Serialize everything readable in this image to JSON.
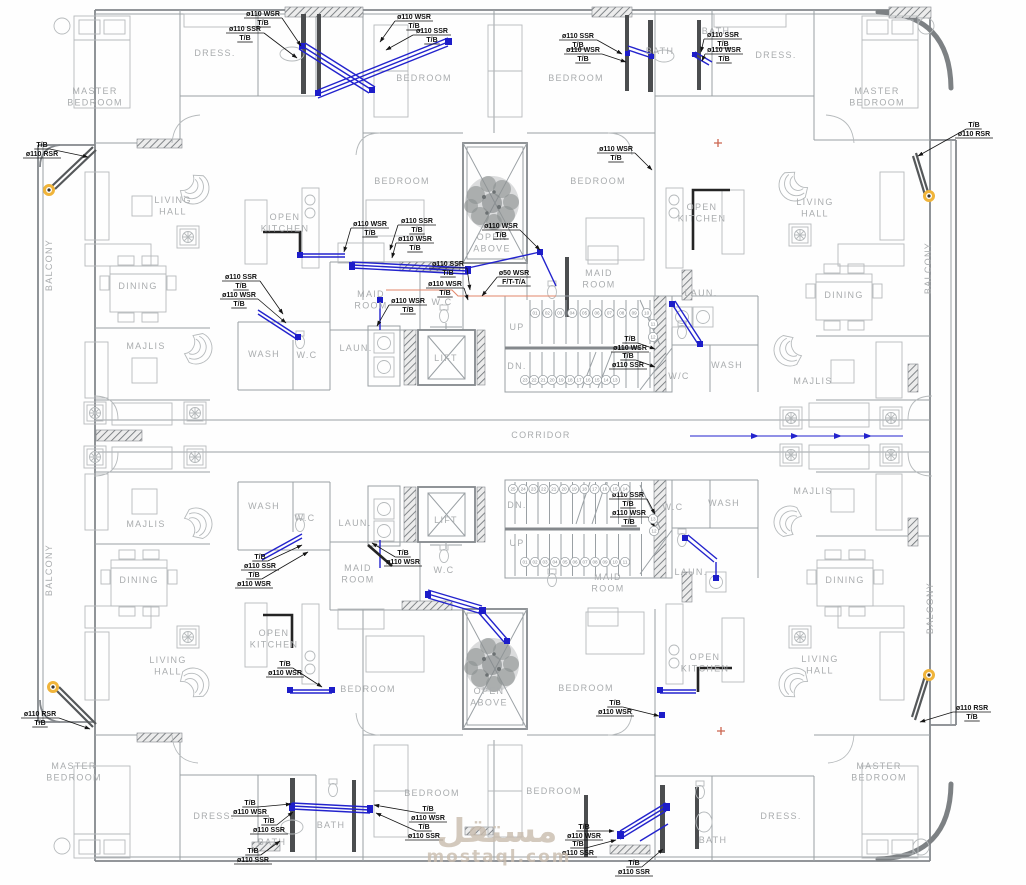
{
  "watermark": {
    "arabic": "مستقل",
    "latin": "mostaql.com"
  },
  "colors": {
    "pipe_blue": "#2323cd",
    "wall_gray": "#9aa0a4",
    "annotation_black": "#0f0f0f",
    "room_text_gray": "#a9acae",
    "rsr_marker_yellow": "#f0b43a",
    "orange_line": "#e2876a",
    "marker_red": "#cc6650",
    "watermark_tan": "#c9bcae"
  },
  "room_labels": [
    {
      "name": "master-bedroom-tl",
      "lines": [
        "MASTER",
        "BEDROOM"
      ],
      "x": 95,
      "y": 94
    },
    {
      "name": "dress-tl",
      "lines": [
        "DRESS."
      ],
      "x": 215,
      "y": 56
    },
    {
      "name": "bedroom-top-1",
      "lines": [
        "BEDROOM"
      ],
      "x": 424,
      "y": 81
    },
    {
      "name": "bedroom-top-2",
      "lines": [
        "BEDROOM"
      ],
      "x": 576,
      "y": 81
    },
    {
      "name": "bath-top-center",
      "lines": [
        "BATH"
      ],
      "x": 660,
      "y": 54
    },
    {
      "name": "bath-top-right",
      "lines": [
        "BATH"
      ],
      "x": 716,
      "y": 34
    },
    {
      "name": "dress-tr",
      "lines": [
        "DRESS."
      ],
      "x": 776,
      "y": 58
    },
    {
      "name": "master-bedroom-tr",
      "lines": [
        "MASTER",
        "BEDROOM"
      ],
      "x": 877,
      "y": 94
    },
    {
      "name": "bedroom-mid-1",
      "lines": [
        "BEDROOM"
      ],
      "x": 402,
      "y": 184
    },
    {
      "name": "bedroom-mid-2",
      "lines": [
        "BEDROOM"
      ],
      "x": 598,
      "y": 184
    },
    {
      "name": "open-above-top",
      "lines": [
        "OPEN",
        "ABOVE"
      ],
      "x": 492,
      "y": 240
    },
    {
      "name": "living-hall-tl",
      "lines": [
        "LIVING",
        "HALL"
      ],
      "x": 173,
      "y": 203
    },
    {
      "name": "open-kitchen-tl",
      "lines": [
        "OPEN",
        "KITCHEN"
      ],
      "x": 285,
      "y": 220
    },
    {
      "name": "open-kitchen-tr",
      "lines": [
        "OPEN",
        "KITCHEN"
      ],
      "x": 702,
      "y": 210
    },
    {
      "name": "living-hall-tr",
      "lines": [
        "LIVING",
        "HALL"
      ],
      "x": 815,
      "y": 205
    },
    {
      "name": "maid-room-top-left",
      "lines": [
        "MAID",
        "ROOM"
      ],
      "x": 371,
      "y": 297
    },
    {
      "name": "maid-room-top-right",
      "lines": [
        "MAID",
        "ROOM"
      ],
      "x": 599,
      "y": 276
    },
    {
      "name": "dining-tl",
      "lines": [
        "DINING"
      ],
      "x": 138,
      "y": 289
    },
    {
      "name": "dining-tr",
      "lines": [
        "DINING"
      ],
      "x": 844,
      "y": 298
    },
    {
      "name": "wash-upper-left",
      "lines": [
        "WASH"
      ],
      "x": 264,
      "y": 357
    },
    {
      "name": "wc-upper-left",
      "lines": [
        "W.C"
      ],
      "x": 307,
      "y": 358
    },
    {
      "name": "wc-upper-center",
      "lines": [
        "W.C"
      ],
      "x": 442,
      "y": 305
    },
    {
      "name": "laun-upper-left",
      "lines": [
        "LAUN."
      ],
      "x": 356,
      "y": 351
    },
    {
      "name": "lift-upper",
      "lines": [
        "LIFT"
      ],
      "x": 446,
      "y": 361
    },
    {
      "name": "majlis-tl",
      "lines": [
        "MAJLIS"
      ],
      "x": 146,
      "y": 349
    },
    {
      "name": "majlis-tr",
      "lines": [
        "MAJLIS"
      ],
      "x": 813,
      "y": 384
    },
    {
      "name": "up-upper",
      "lines": [
        "UP"
      ],
      "x": 517,
      "y": 330
    },
    {
      "name": "dn-upper",
      "lines": [
        "DN."
      ],
      "x": 517,
      "y": 369
    },
    {
      "name": "laun-upper-right",
      "lines": [
        "LAUN."
      ],
      "x": 701,
      "y": 296
    },
    {
      "name": "wash-upper-right",
      "lines": [
        "WASH"
      ],
      "x": 727,
      "y": 368
    },
    {
      "name": "wc-upper-right",
      "lines": [
        "W/C"
      ],
      "x": 679,
      "y": 379
    },
    {
      "name": "corridor",
      "lines": [
        "CORRIDOR"
      ],
      "x": 541,
      "y": 438
    },
    {
      "name": "wash-lower-left",
      "lines": [
        "WASH"
      ],
      "x": 264,
      "y": 509
    },
    {
      "name": "wc-lower-left",
      "lines": [
        "W.C"
      ],
      "x": 305,
      "y": 521
    },
    {
      "name": "majlis-bl",
      "lines": [
        "MAJLIS"
      ],
      "x": 146,
      "y": 527
    },
    {
      "name": "majlis-br",
      "lines": [
        "MAJLIS"
      ],
      "x": 813,
      "y": 494
    },
    {
      "name": "laun-lower-left",
      "lines": [
        "LAUN."
      ],
      "x": 355,
      "y": 526
    },
    {
      "name": "lift-lower",
      "lines": [
        "LIFT"
      ],
      "x": 446,
      "y": 523
    },
    {
      "name": "dn-lower",
      "lines": [
        "DN."
      ],
      "x": 517,
      "y": 508
    },
    {
      "name": "up-lower",
      "lines": [
        "UP"
      ],
      "x": 517,
      "y": 546
    },
    {
      "name": "wc-lower-center",
      "lines": [
        "W.C"
      ],
      "x": 444,
      "y": 573
    },
    {
      "name": "maid-room-lower-left",
      "lines": [
        "MAID",
        "ROOM"
      ],
      "x": 358,
      "y": 571
    },
    {
      "name": "maid-room-lower-right",
      "lines": [
        "MAID",
        "ROOM"
      ],
      "x": 608,
      "y": 580
    },
    {
      "name": "wc-lower-right",
      "lines": [
        "W.C"
      ],
      "x": 673,
      "y": 510
    },
    {
      "name": "wash-lower-right",
      "lines": [
        "WASH"
      ],
      "x": 724,
      "y": 506
    },
    {
      "name": "laun-lower-right",
      "lines": [
        "LAUN."
      ],
      "x": 691,
      "y": 575
    },
    {
      "name": "dining-bl",
      "lines": [
        "DINING"
      ],
      "x": 139,
      "y": 583
    },
    {
      "name": "dining-br",
      "lines": [
        "DINING"
      ],
      "x": 845,
      "y": 583
    },
    {
      "name": "living-hall-bl",
      "lines": [
        "LIVING",
        "HALL"
      ],
      "x": 168,
      "y": 663
    },
    {
      "name": "open-kitchen-bl",
      "lines": [
        "OPEN",
        "KITCHEN"
      ],
      "x": 274,
      "y": 636
    },
    {
      "name": "open-kitchen-br",
      "lines": [
        "OPEN",
        "KITCHEN"
      ],
      "x": 705,
      "y": 660
    },
    {
      "name": "living-hall-br",
      "lines": [
        "LIVING",
        "HALL"
      ],
      "x": 820,
      "y": 662
    },
    {
      "name": "open-above-bottom",
      "lines": [
        "OPEN",
        "ABOVE"
      ],
      "x": 489,
      "y": 694
    },
    {
      "name": "bedroom-low-1",
      "lines": [
        "BEDROOM"
      ],
      "x": 368,
      "y": 692
    },
    {
      "name": "bedroom-low-2",
      "lines": [
        "BEDROOM"
      ],
      "x": 586,
      "y": 691
    },
    {
      "name": "master-bedroom-bl",
      "lines": [
        "MASTER",
        "BEDROOM"
      ],
      "x": 74,
      "y": 769
    },
    {
      "name": "master-bedroom-br",
      "lines": [
        "MASTER",
        "BEDROOM"
      ],
      "x": 879,
      "y": 769
    },
    {
      "name": "dress-bl",
      "lines": [
        "DRESS."
      ],
      "x": 214,
      "y": 819
    },
    {
      "name": "dress-br",
      "lines": [
        "DRESS."
      ],
      "x": 781,
      "y": 819
    },
    {
      "name": "bath-bl",
      "lines": [
        "BATH"
      ],
      "x": 272,
      "y": 845
    },
    {
      "name": "bath-bottom-center",
      "lines": [
        "BATH"
      ],
      "x": 331,
      "y": 828
    },
    {
      "name": "bath-br",
      "lines": [
        "BATH"
      ],
      "x": 713,
      "y": 843
    },
    {
      "name": "bedroom-bottom-1",
      "lines": [
        "BEDROOM"
      ],
      "x": 432,
      "y": 796
    },
    {
      "name": "bedroom-bottom-2",
      "lines": [
        "BEDROOM"
      ],
      "x": 554,
      "y": 794
    },
    {
      "name": "balcony-left-top",
      "lines": [
        "BALCONY"
      ],
      "x": 52,
      "y": 265,
      "rot": -90
    },
    {
      "name": "balcony-left-bottom",
      "lines": [
        "BALCONY"
      ],
      "x": 52,
      "y": 570,
      "rot": -90
    },
    {
      "name": "balcony-right-top",
      "lines": [
        "BALCONY"
      ],
      "x": 931,
      "y": 268,
      "rot": -90
    },
    {
      "name": "balcony-right-bottom",
      "lines": [
        "BALCONY"
      ],
      "x": 933,
      "y": 608,
      "rot": -90
    }
  ],
  "annotations": [
    {
      "lines": [
        "ø110 WSR",
        "T/B"
      ],
      "x": 263,
      "y": 16,
      "tx": 301,
      "ty": 46
    },
    {
      "lines": [
        "ø110 SSR",
        "T/B"
      ],
      "x": 245,
      "y": 31,
      "tx": 297,
      "ty": 58
    },
    {
      "lines": [
        "ø110 WSR",
        "T/B"
      ],
      "x": 414,
      "y": 19,
      "tx": 380,
      "ty": 42
    },
    {
      "lines": [
        "ø110 SSR",
        "T/B"
      ],
      "x": 432,
      "y": 33,
      "tx": 386,
      "ty": 50
    },
    {
      "lines": [
        "ø110 SSR",
        "T/B"
      ],
      "x": 578,
      "y": 38,
      "tx": 622,
      "ty": 54
    },
    {
      "lines": [
        "ø110 WSR",
        "T/B"
      ],
      "x": 583,
      "y": 52,
      "tx": 626,
      "ty": 62
    },
    {
      "lines": [
        "ø110 SSR",
        "T/B"
      ],
      "x": 723,
      "y": 37,
      "tx": 701,
      "ty": 52
    },
    {
      "lines": [
        "ø110 WSR",
        "T/B"
      ],
      "x": 724,
      "y": 52,
      "tx": 702,
      "ty": 61
    },
    {
      "lines": [
        "T/B",
        "ø110 RSR"
      ],
      "x": 42,
      "y": 147,
      "tx": 88,
      "ty": 157
    },
    {
      "lines": [
        "T/B",
        "ø110 RSR"
      ],
      "x": 974,
      "y": 127,
      "tx": 918,
      "ty": 156
    },
    {
      "lines": [
        "ø110 WSR",
        "T/B"
      ],
      "x": 370,
      "y": 226,
      "tx": 344,
      "ty": 252
    },
    {
      "lines": [
        "ø110 SSR",
        "T/B"
      ],
      "x": 417,
      "y": 223,
      "tx": 390,
      "ty": 250
    },
    {
      "lines": [
        "ø110 WSR",
        "T/B"
      ],
      "x": 415,
      "y": 241,
      "tx": 392,
      "ty": 258
    },
    {
      "lines": [
        "ø110 WSR",
        "T/B"
      ],
      "x": 501,
      "y": 228,
      "tx": 540,
      "ty": 250
    },
    {
      "lines": [
        "ø50 WSR",
        "F/T-T/A"
      ],
      "x": 514,
      "y": 275,
      "tx": 482,
      "ty": 296
    },
    {
      "lines": [
        "ø110 SSR",
        "T/B"
      ],
      "x": 448,
      "y": 266,
      "tx": 470,
      "ty": 290
    },
    {
      "lines": [
        "ø110 WSR",
        "T/B"
      ],
      "x": 445,
      "y": 286,
      "tx": 468,
      "ty": 300
    },
    {
      "lines": [
        "ø110 SSR",
        "T/B"
      ],
      "x": 241,
      "y": 279,
      "tx": 283,
      "ty": 314
    },
    {
      "lines": [
        "ø110 WSR",
        "T/B"
      ],
      "x": 239,
      "y": 297,
      "tx": 286,
      "ty": 323
    },
    {
      "lines": [
        "ø110 WSR",
        "T/B"
      ],
      "x": 408,
      "y": 303,
      "tx": 377,
      "ty": 326
    },
    {
      "lines": [
        "ø110 WSR",
        "T/B"
      ],
      "x": 616,
      "y": 151,
      "tx": 652,
      "ty": 170
    },
    {
      "lines": [
        "T/B",
        "ø110 WSR"
      ],
      "x": 630,
      "y": 341,
      "tx": 655,
      "ty": 349
    },
    {
      "lines": [
        "T/B",
        "ø110 SSR"
      ],
      "x": 628,
      "y": 358,
      "tx": 655,
      "ty": 367
    },
    {
      "lines": [
        "ø110 SSR",
        "T/B"
      ],
      "x": 628,
      "y": 497,
      "tx": 655,
      "ty": 514
    },
    {
      "lines": [
        "ø110 WSR",
        "T/B"
      ],
      "x": 629,
      "y": 515,
      "tx": 655,
      "ty": 527
    },
    {
      "lines": [
        "T/B",
        "ø110 SSR"
      ],
      "x": 260,
      "y": 559,
      "tx": 302,
      "ty": 545
    },
    {
      "lines": [
        "T/B",
        "ø110 WSR"
      ],
      "x": 254,
      "y": 577,
      "tx": 308,
      "ty": 552
    },
    {
      "lines": [
        "T/B",
        "ø110 WSR"
      ],
      "x": 403,
      "y": 555,
      "tx": 372,
      "ty": 543
    },
    {
      "lines": [
        "T/B",
        "ø110 WSR"
      ],
      "x": 285,
      "y": 666,
      "tx": 322,
      "ty": 687
    },
    {
      "lines": [
        "ø110 RSR",
        "T/B"
      ],
      "x": 40,
      "y": 716,
      "tx": 90,
      "ty": 729
    },
    {
      "lines": [
        "T/B",
        "ø110 WSR"
      ],
      "x": 615,
      "y": 705,
      "tx": 659,
      "ty": 716
    },
    {
      "lines": [
        "T/B",
        "ø110 WSR"
      ],
      "x": 250,
      "y": 805,
      "tx": 291,
      "ty": 804
    },
    {
      "lines": [
        "T/B",
        "ø110 SSR"
      ],
      "x": 269,
      "y": 823,
      "tx": 293,
      "ty": 812
    },
    {
      "lines": [
        "T/B",
        "ø110 WSR"
      ],
      "x": 428,
      "y": 811,
      "tx": 374,
      "ty": 805
    },
    {
      "lines": [
        "T/B",
        "ø110 SSR"
      ],
      "x": 424,
      "y": 829,
      "tx": 376,
      "ty": 813
    },
    {
      "lines": [
        "T/B",
        "ø110 WSR"
      ],
      "x": 584,
      "y": 829,
      "tx": 614,
      "ty": 831
    },
    {
      "lines": [
        "T/B",
        "ø110 SSR"
      ],
      "x": 578,
      "y": 846,
      "tx": 616,
      "ty": 840
    },
    {
      "lines": [
        "T/B",
        "ø110 SSR"
      ],
      "x": 253,
      "y": 853,
      "tx": 280,
      "ty": 841
    },
    {
      "lines": [
        "T/B",
        "ø110 SSR"
      ],
      "x": 634,
      "y": 865,
      "tx": 663,
      "ty": 849
    },
    {
      "lines": [
        "ø110 RSR",
        "T/B"
      ],
      "x": 972,
      "y": 710,
      "tx": 920,
      "ty": 722
    }
  ],
  "stairs": {
    "upper": {
      "rows": [
        {
          "y": 313,
          "x0": 535,
          "dx": 12.4,
          "nums": [
            "01",
            "02",
            "03",
            "04",
            "05",
            "06",
            "07",
            "08",
            "09",
            "10"
          ]
        },
        {
          "y": 380,
          "x0": 525,
          "dx": 9.0,
          "nums": [
            "23",
            "22",
            "21",
            "20",
            "19",
            "18",
            "17",
            "16",
            "15",
            "14",
            "13"
          ]
        }
      ],
      "side": [
        {
          "n": "11",
          "x": 653,
          "y": 324
        },
        {
          "n": "12",
          "x": 653,
          "y": 337
        }
      ]
    },
    "lower": {
      "rows": [
        {
          "y": 489,
          "x0": 513,
          "dx": 10.2,
          "nums": [
            "25",
            "24",
            "23",
            "22",
            "21",
            "20",
            "19",
            "18",
            "17",
            "16",
            "15",
            "14"
          ]
        },
        {
          "y": 562,
          "x0": 525,
          "dx": 10.0,
          "nums": [
            "01",
            "02",
            "03",
            "04",
            "05",
            "06",
            "07",
            "08",
            "09",
            "10",
            "11"
          ]
        }
      ],
      "side": [
        {
          "n": "13",
          "x": 653,
          "y": 519
        },
        {
          "n": "12",
          "x": 654,
          "y": 531
        }
      ]
    }
  }
}
